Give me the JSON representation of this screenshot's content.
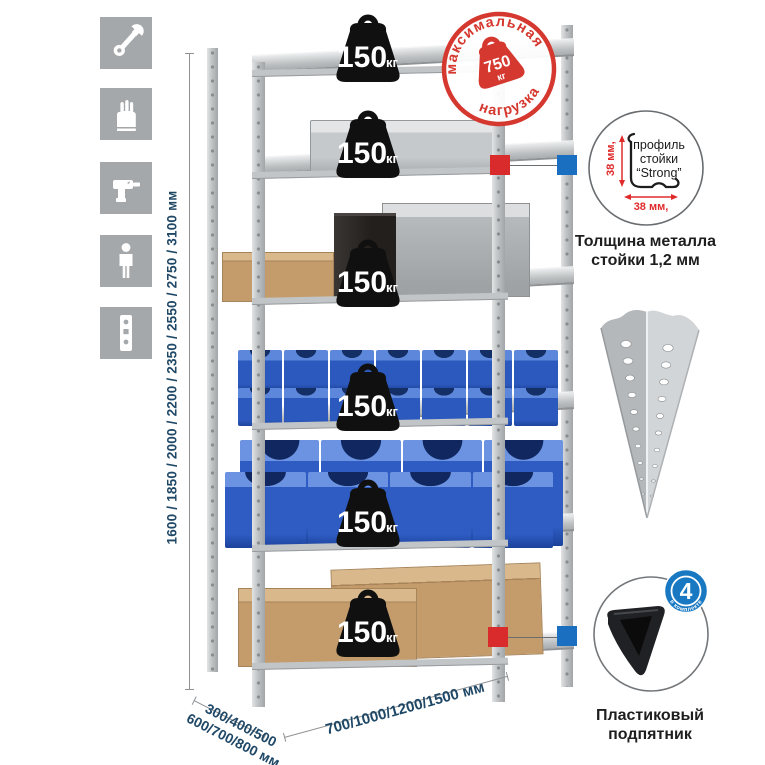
{
  "stamp": {
    "top_text": "максимальная",
    "bottom_text": "нагрузка",
    "value": "750",
    "unit": "кг"
  },
  "rack": {
    "shelf_count": 6,
    "shelf_load": "150",
    "load_unit": "кг"
  },
  "dimensions": {
    "height": "1600 / 1850 / 2000 / 2200 / 2350 / 2550 / 2750 / 3100 мм",
    "depth_line1": "300/400/500",
    "depth_line2": "600/700/800 мм",
    "width": "700/1000/1200/1500 мм"
  },
  "profile_callout": {
    "line1": "профиль",
    "line2": "стойки",
    "line3": "“Strong”",
    "dim_vertical": "38 мм,",
    "dim_horizontal": "38 мм,",
    "caption_line1": "Толщина металла",
    "caption_line2": "стойки 1,2 мм"
  },
  "foot_callout": {
    "badge_value": "4",
    "badge_text": "в комплекте",
    "caption_line1": "Пластиковый",
    "caption_line2": "подпятник"
  },
  "sidebar": {
    "icons": [
      "wrench-icon",
      "gloves-icon",
      "drill-icon",
      "person-icon",
      "rack-profile-icon"
    ]
  },
  "colors": {
    "stamp_red": "#d5382f",
    "marker_red": "#d92b2b",
    "marker_blue": "#1b6fc0",
    "badge_blue": "#1878c2",
    "dim_text_navy": "#1f4766",
    "bin_blue": "#2c59bd",
    "icon_gray": "#a5a8aa"
  }
}
